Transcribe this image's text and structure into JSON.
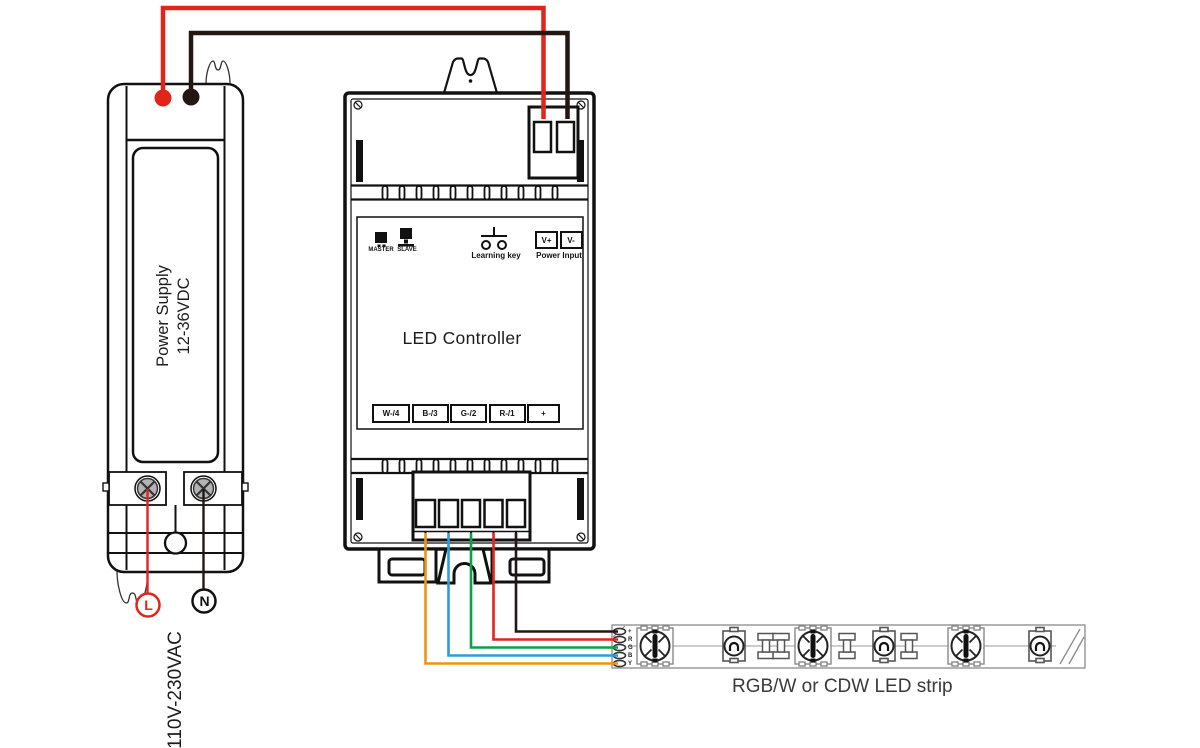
{
  "power_supply": {
    "name_line1": "Power Supply",
    "name_line2": "12-36VDC",
    "ac_input": "110V-230VAC",
    "live_label": "L",
    "neutral_label": "N"
  },
  "controller": {
    "title": "LED Controller",
    "master_label": "MASTER",
    "slave_label": "SLAVE",
    "learning_key_label": "Learning key",
    "power_input_label": "Power Input",
    "power_terminals": [
      {
        "label": "V+"
      },
      {
        "label": "V-"
      }
    ],
    "output_terminals": [
      {
        "label": "W-/4"
      },
      {
        "label": "B-/3"
      },
      {
        "label": "G-/2"
      },
      {
        "label": "R-/1"
      },
      {
        "label": "+"
      }
    ]
  },
  "led_strip": {
    "caption": "RGB/W or CDW LED strip",
    "pads": [
      {
        "label": "+"
      },
      {
        "label": "R"
      },
      {
        "label": "G"
      },
      {
        "label": "B"
      },
      {
        "label": "Y"
      }
    ]
  },
  "wire_colors": {
    "dc_positive": "#e1251b",
    "dc_negative": "#241712",
    "channel_w": "#e9960e",
    "channel_b": "#2e9cd6",
    "channel_g": "#0aa14c",
    "channel_r": "#e1251b",
    "common_plus": "#241712"
  }
}
